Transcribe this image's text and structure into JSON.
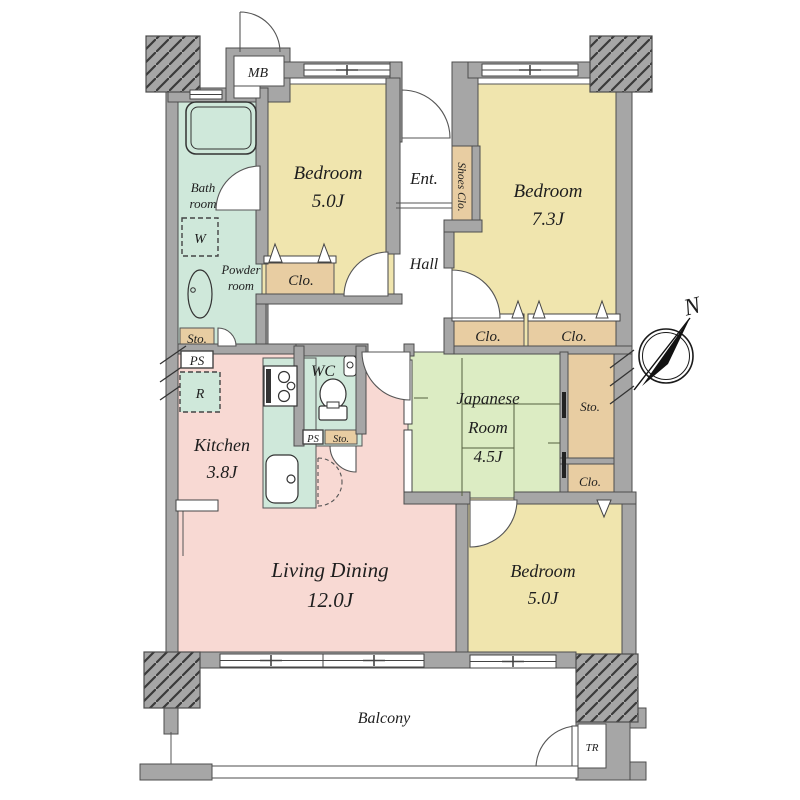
{
  "rooms": {
    "bedroom1": {
      "name": "Bedroom",
      "area": "5.0J"
    },
    "bedroom2": {
      "name": "Bedroom",
      "area": "7.3J"
    },
    "bedroom3": {
      "name": "Bedroom",
      "area": "5.0J"
    },
    "japanese_room": {
      "name1": "Japanese",
      "name2": "Room",
      "area": "4.5J"
    },
    "living_dining": {
      "name": "Living Dining",
      "area": "12.0J"
    },
    "kitchen": {
      "name": "Kitchen",
      "area": "3.8J"
    },
    "bath": {
      "name1": "Bath",
      "name2": "room"
    },
    "powder": {
      "name1": "Powder",
      "name2": "room"
    },
    "wc": {
      "name": "WC"
    },
    "entrance": {
      "name": "Ent."
    },
    "hall": {
      "name": "Hall"
    },
    "balcony": {
      "name": "Balcony"
    }
  },
  "storage": {
    "shoes_closet": "Shoes Clo.",
    "closet": "Clo.",
    "storage": "Sto.",
    "washer": "W",
    "refrigerator": "R",
    "pipe_space": "PS",
    "meter_box": "MB",
    "trunk_room": "TR"
  },
  "compass": {
    "north": "N"
  },
  "colors": {
    "wall": "#a6a6a6",
    "wall_line": "#4d4d4d",
    "bedroom": "#f0e5ae",
    "tatami": "#dcecc3",
    "wet_area": "#cfe8da",
    "living": "#f8d9d3",
    "closet": "#e8cda2"
  }
}
